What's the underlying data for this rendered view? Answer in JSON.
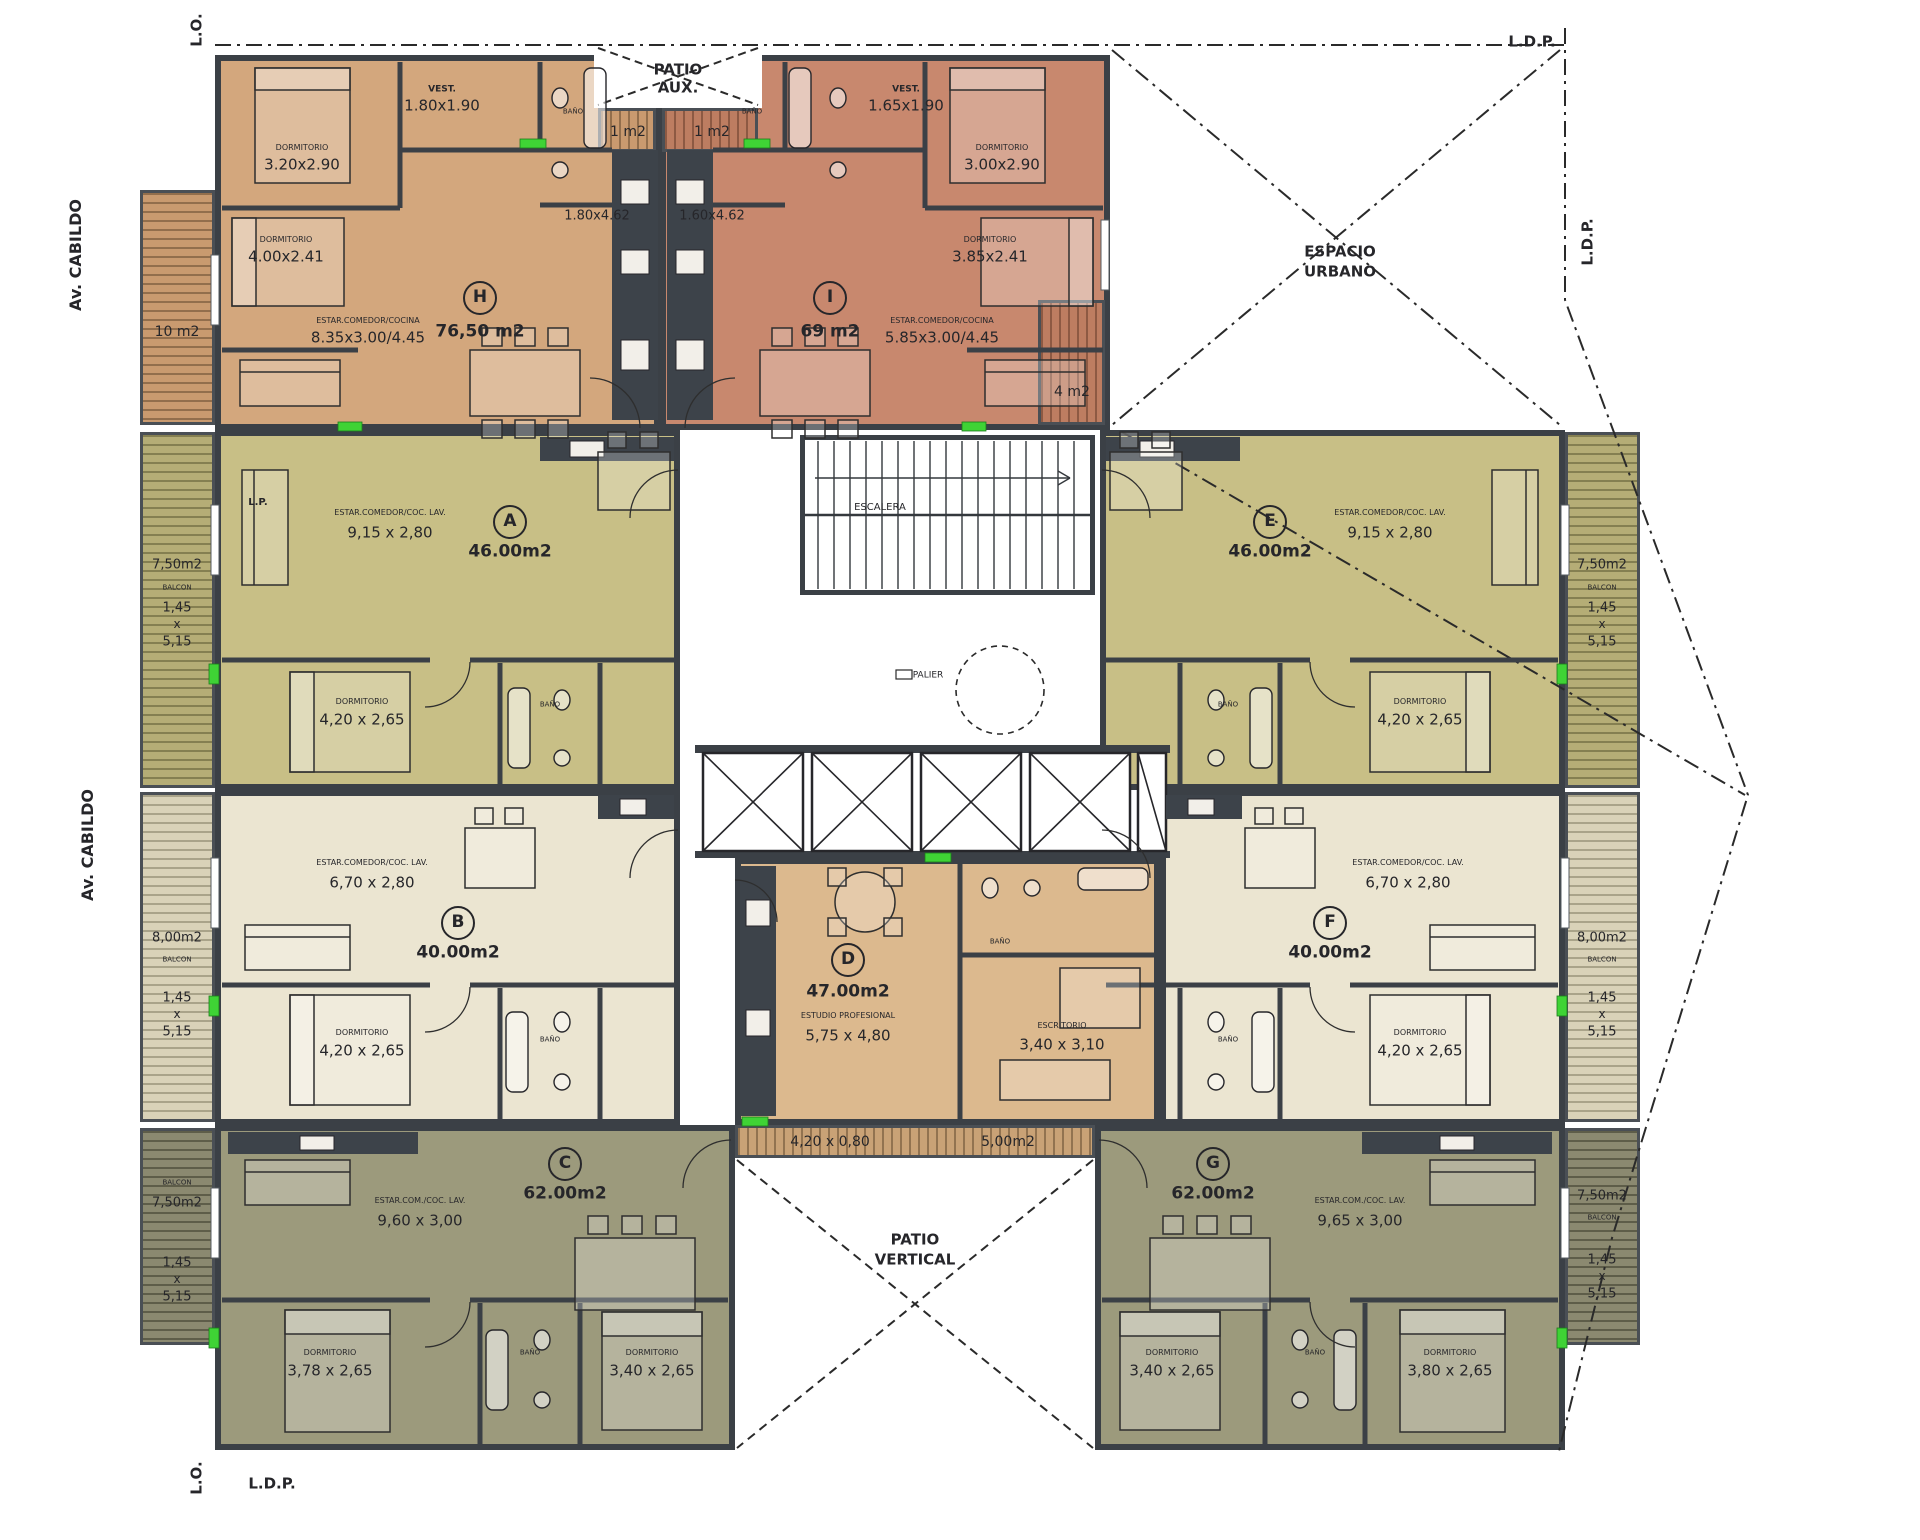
{
  "plan": {
    "street": "Av. CABILDO",
    "boundary_marks": [
      "L.O.",
      "L.D.P."
    ],
    "zones": [
      "PATIO AUX.",
      "ESPACIO URBANO",
      "PATIO VERTICAL",
      "ESCALERA",
      "PALIER"
    ]
  },
  "colors": {
    "unit_h": "#d3a77d",
    "unit_i": "#c8886e",
    "unit_a_e": "#c8bf86",
    "unit_b_f": "#ebe5d1",
    "unit_c_g": "#9c9a7c",
    "unit_d": "#dcb98e",
    "walls": "#3b4046",
    "accent_green": "#3fd335"
  },
  "units": [
    {
      "letter": "H",
      "area": "76,50 m2",
      "rooms": [
        {
          "name": "VEST.",
          "dims": "1.80x1.90"
        },
        {
          "name": "DORMITORIO",
          "dims": "3.20x2.90"
        },
        {
          "name": "DORMITORIO",
          "dims": "4.00x2.41"
        },
        {
          "name": "ESTAR.COMEDOR/COCINA",
          "dims": "8.35x3.00/4.45"
        },
        {
          "name": "COCINA",
          "dims": "1.80x4.62"
        }
      ],
      "balconies": [
        "10 m2",
        "1 m2"
      ]
    },
    {
      "letter": "I",
      "area": "69 m2",
      "rooms": [
        {
          "name": "VEST.",
          "dims": "1.65x1.90"
        },
        {
          "name": "DORMITORIO",
          "dims": "3.00x2.90"
        },
        {
          "name": "DORMITORIO",
          "dims": "3.85x2.41"
        },
        {
          "name": "ESTAR.COMEDOR/COCINA",
          "dims": "5.85x3.00/4.45"
        },
        {
          "name": "COCINA",
          "dims": "1.60x4.62"
        }
      ],
      "balconies": [
        "4 m2",
        "1 m2"
      ]
    },
    {
      "letter": "A",
      "area": "46.00m2",
      "rooms": [
        {
          "name": "ESTAR.COMEDOR/COC. LAV.",
          "dims": "9,15 x 2,80"
        },
        {
          "name": "DORMITORIO",
          "dims": "4,20 x 2,65"
        }
      ],
      "balconies": [
        "7,50m2 (1,45 x 5,15)"
      ]
    },
    {
      "letter": "B",
      "area": "40.00m2",
      "rooms": [
        {
          "name": "ESTAR.COMEDOR/COC. LAV.",
          "dims": "6,70 x 2,80"
        },
        {
          "name": "DORMITORIO",
          "dims": "4,20 x 2,65"
        }
      ],
      "balconies": [
        "8,00m2 (1,45 x 5,15)"
      ]
    },
    {
      "letter": "C",
      "area": "62.00m2",
      "rooms": [
        {
          "name": "ESTAR.COM./COC. LAV.",
          "dims": "9,60 x 3,00"
        },
        {
          "name": "DORMITORIO",
          "dims": "3,78 x 2,65"
        },
        {
          "name": "DORMITORIO",
          "dims": "3,40 x 2,65"
        }
      ],
      "balconies": [
        "7,50m2 (1,45 x 5,15)"
      ]
    },
    {
      "letter": "D",
      "area": "47.00m2",
      "rooms": [
        {
          "name": "ESTUDIO PROFESIONAL",
          "dims": "5,75 x 4,80"
        },
        {
          "name": "ESCRITORIO",
          "dims": "3,40 x 3,10"
        }
      ],
      "balconies": [
        "5,00m2 (4,20 x 0,80)"
      ]
    },
    {
      "letter": "E",
      "area": "46.00m2",
      "rooms": [
        {
          "name": "ESTAR.COMEDOR/COC. LAV.",
          "dims": "9,15 x 2,80"
        },
        {
          "name": "DORMITORIO",
          "dims": "4,20 x 2,65"
        }
      ],
      "balconies": [
        "7,50m2 (1,45 x 5,15)"
      ]
    },
    {
      "letter": "F",
      "area": "40.00m2",
      "rooms": [
        {
          "name": "ESTAR.COMEDOR/COC. LAV.",
          "dims": "6,70 x 2,80"
        },
        {
          "name": "DORMITORIO",
          "dims": "4,20 x 2,65"
        }
      ],
      "balconies": [
        "8,00m2 (1,45 x 5,15)"
      ]
    },
    {
      "letter": "G",
      "area": "62.00m2",
      "rooms": [
        {
          "name": "ESTAR.COM./COC. LAV.",
          "dims": "9,65 x 3,00"
        },
        {
          "name": "DORMITORIO",
          "dims": "3,40 x 2,65"
        },
        {
          "name": "DORMITORIO",
          "dims": "3,80 x 2,65"
        }
      ],
      "balconies": [
        "7,50m2 (1,45 x 5,15)"
      ]
    }
  ],
  "unit_badges": [
    {
      "letter": "H",
      "x": 480,
      "y": 298
    },
    {
      "letter": "I",
      "x": 830,
      "y": 298
    },
    {
      "letter": "A",
      "x": 510,
      "y": 522
    },
    {
      "letter": "E",
      "x": 1270,
      "y": 522
    },
    {
      "letter": "B",
      "x": 458,
      "y": 923
    },
    {
      "letter": "F",
      "x": 1330,
      "y": 923
    },
    {
      "letter": "C",
      "x": 565,
      "y": 1164
    },
    {
      "letter": "G",
      "x": 1213,
      "y": 1164
    },
    {
      "letter": "D",
      "x": 848,
      "y": 960
    }
  ],
  "labels": [
    {
      "t": "L.O.",
      "x": 197,
      "y": 30,
      "fs": 15,
      "b": 1,
      "rot": 1
    },
    {
      "t": "Av. CABILDO",
      "x": 76,
      "y": 255,
      "fs": 16,
      "b": 1,
      "rot": 1
    },
    {
      "t": "Av. CABILDO",
      "x": 88,
      "y": 845,
      "fs": 16,
      "b": 1,
      "rot": 1
    },
    {
      "t": "L.D.P.",
      "x": 1532,
      "y": 42,
      "fs": 15,
      "b": 1
    },
    {
      "t": "L.D.P.",
      "x": 1588,
      "y": 242,
      "fs": 15,
      "b": 1,
      "rot": 1
    },
    {
      "t": "L.O.",
      "x": 197,
      "y": 1478,
      "fs": 15,
      "b": 1,
      "rot": 1
    },
    {
      "t": "L.D.P.",
      "x": 272,
      "y": 1484,
      "fs": 15,
      "b": 1
    },
    {
      "t": "L.P.",
      "x": 258,
      "y": 503,
      "fs": 10,
      "b": 1
    },
    {
      "t": "PATIO",
      "x": 678,
      "y": 70,
      "fs": 15,
      "b": 1
    },
    {
      "t": "AUX.",
      "x": 678,
      "y": 88,
      "fs": 15,
      "b": 1
    },
    {
      "t": "ESPACIO",
      "x": 1340,
      "y": 252,
      "fs": 15,
      "b": 1
    },
    {
      "t": "URBANO",
      "x": 1340,
      "y": 272,
      "fs": 15,
      "b": 1
    },
    {
      "t": "PATIO",
      "x": 915,
      "y": 1240,
      "fs": 15,
      "b": 1
    },
    {
      "t": "VERTICAL",
      "x": 915,
      "y": 1260,
      "fs": 15,
      "b": 1
    },
    {
      "t": "ESCALERA",
      "x": 880,
      "y": 508,
      "fs": 10
    },
    {
      "t": "PALIER",
      "x": 928,
      "y": 676,
      "fs": 9
    },
    {
      "t": "1 m2",
      "x": 628,
      "y": 132,
      "fs": 14
    },
    {
      "t": "1 m2",
      "x": 712,
      "y": 132,
      "fs": 14
    },
    {
      "t": "10 m2",
      "x": 177,
      "y": 332,
      "fs": 14
    },
    {
      "t": "4 m2",
      "x": 1072,
      "y": 392,
      "fs": 14
    },
    {
      "t": "VEST.",
      "x": 442,
      "y": 90,
      "fs": 9,
      "b": 1
    },
    {
      "t": "1.80x1.90",
      "x": 442,
      "y": 106,
      "fs": 15
    },
    {
      "t": "DORMITORIO",
      "x": 302,
      "y": 148,
      "fs": 8
    },
    {
      "t": "3.20x2.90",
      "x": 302,
      "y": 165,
      "fs": 15
    },
    {
      "t": "DORMITORIO",
      "x": 286,
      "y": 240,
      "fs": 8
    },
    {
      "t": "4.00x2.41",
      "x": 286,
      "y": 257,
      "fs": 15
    },
    {
      "t": "76,50 m2",
      "x": 480,
      "y": 332,
      "fs": 17,
      "b": 1
    },
    {
      "t": "ESTAR.COMEDOR/COCINA",
      "x": 368,
      "y": 321,
      "fs": 8
    },
    {
      "t": "8.35x3.00/4.45",
      "x": 368,
      "y": 338,
      "fs": 15
    },
    {
      "t": "1.80x4.62",
      "x": 597,
      "y": 216,
      "fs": 13
    },
    {
      "t": "BAÑO",
      "x": 573,
      "y": 112,
      "fs": 7
    },
    {
      "t": "VEST.",
      "x": 906,
      "y": 90,
      "fs": 9,
      "b": 1
    },
    {
      "t": "1.65x1.90",
      "x": 906,
      "y": 106,
      "fs": 15
    },
    {
      "t": "DORMITORIO",
      "x": 1002,
      "y": 148,
      "fs": 8
    },
    {
      "t": "3.00x2.90",
      "x": 1002,
      "y": 165,
      "fs": 15
    },
    {
      "t": "DORMITORIO",
      "x": 990,
      "y": 240,
      "fs": 8
    },
    {
      "t": "3.85x2.41",
      "x": 990,
      "y": 257,
      "fs": 15
    },
    {
      "t": "69 m2",
      "x": 830,
      "y": 332,
      "fs": 17,
      "b": 1
    },
    {
      "t": "ESTAR.COMEDOR/COCINA",
      "x": 942,
      "y": 321,
      "fs": 8
    },
    {
      "t": "5.85x3.00/4.45",
      "x": 942,
      "y": 338,
      "fs": 15
    },
    {
      "t": "1.60x4.62",
      "x": 712,
      "y": 216,
      "fs": 13
    },
    {
      "t": "BAÑO",
      "x": 752,
      "y": 112,
      "fs": 7
    },
    {
      "t": "ESTAR.COMEDOR/COC. LAV.",
      "x": 390,
      "y": 513,
      "fs": 8
    },
    {
      "t": "9,15 x 2,80",
      "x": 390,
      "y": 533,
      "fs": 15
    },
    {
      "t": "46.00m2",
      "x": 510,
      "y": 552,
      "fs": 17,
      "b": 1
    },
    {
      "t": "DORMITORIO",
      "x": 362,
      "y": 702,
      "fs": 8
    },
    {
      "t": "4,20 x 2,65",
      "x": 362,
      "y": 720,
      "fs": 15
    },
    {
      "t": "BAÑO",
      "x": 550,
      "y": 705,
      "fs": 7
    },
    {
      "t": "7,50m2",
      "x": 177,
      "y": 565,
      "fs": 13
    },
    {
      "t": "BALCON",
      "x": 177,
      "y": 588,
      "fs": 7
    },
    {
      "t": "1,45",
      "x": 177,
      "y": 608,
      "fs": 13
    },
    {
      "t": "x",
      "x": 177,
      "y": 624,
      "fs": 12
    },
    {
      "t": "5,15",
      "x": 177,
      "y": 642,
      "fs": 13
    },
    {
      "t": "ESTAR.COMEDOR/COC. LAV.",
      "x": 1390,
      "y": 513,
      "fs": 8
    },
    {
      "t": "9,15 x 2,80",
      "x": 1390,
      "y": 533,
      "fs": 15
    },
    {
      "t": "46.00m2",
      "x": 1270,
      "y": 552,
      "fs": 17,
      "b": 1
    },
    {
      "t": "DORMITORIO",
      "x": 1420,
      "y": 702,
      "fs": 8
    },
    {
      "t": "4,20 x 2,65",
      "x": 1420,
      "y": 720,
      "fs": 15
    },
    {
      "t": "BAÑO",
      "x": 1228,
      "y": 705,
      "fs": 7
    },
    {
      "t": "7,50m2",
      "x": 1602,
      "y": 565,
      "fs": 13
    },
    {
      "t": "BALCON",
      "x": 1602,
      "y": 588,
      "fs": 7
    },
    {
      "t": "1,45",
      "x": 1602,
      "y": 608,
      "fs": 13
    },
    {
      "t": "x",
      "x": 1602,
      "y": 624,
      "fs": 12
    },
    {
      "t": "5,15",
      "x": 1602,
      "y": 642,
      "fs": 13
    },
    {
      "t": "ESTAR.COMEDOR/COC. LAV.",
      "x": 372,
      "y": 863,
      "fs": 8
    },
    {
      "t": "6,70 x 2,80",
      "x": 372,
      "y": 883,
      "fs": 15
    },
    {
      "t": "40.00m2",
      "x": 458,
      "y": 953,
      "fs": 17,
      "b": 1
    },
    {
      "t": "DORMITORIO",
      "x": 362,
      "y": 1033,
      "fs": 8
    },
    {
      "t": "4,20 x 2,65",
      "x": 362,
      "y": 1051,
      "fs": 15
    },
    {
      "t": "BAÑO",
      "x": 550,
      "y": 1040,
      "fs": 7
    },
    {
      "t": "8,00m2",
      "x": 177,
      "y": 938,
      "fs": 13
    },
    {
      "t": "BALCON",
      "x": 177,
      "y": 960,
      "fs": 7
    },
    {
      "t": "1,45",
      "x": 177,
      "y": 998,
      "fs": 13
    },
    {
      "t": "x",
      "x": 177,
      "y": 1014,
      "fs": 12
    },
    {
      "t": "5,15",
      "x": 177,
      "y": 1032,
      "fs": 13
    },
    {
      "t": "ESTAR.COMEDOR/COC. LAV.",
      "x": 1408,
      "y": 863,
      "fs": 8
    },
    {
      "t": "6,70 x 2,80",
      "x": 1408,
      "y": 883,
      "fs": 15
    },
    {
      "t": "40.00m2",
      "x": 1330,
      "y": 953,
      "fs": 17,
      "b": 1
    },
    {
      "t": "DORMITORIO",
      "x": 1420,
      "y": 1033,
      "fs": 8
    },
    {
      "t": "4,20 x 2,65",
      "x": 1420,
      "y": 1051,
      "fs": 15
    },
    {
      "t": "BAÑO",
      "x": 1228,
      "y": 1040,
      "fs": 7
    },
    {
      "t": "8,00m2",
      "x": 1602,
      "y": 938,
      "fs": 13
    },
    {
      "t": "BALCON",
      "x": 1602,
      "y": 960,
      "fs": 7
    },
    {
      "t": "1,45",
      "x": 1602,
      "y": 998,
      "fs": 13
    },
    {
      "t": "x",
      "x": 1602,
      "y": 1014,
      "fs": 12
    },
    {
      "t": "5,15",
      "x": 1602,
      "y": 1032,
      "fs": 13
    },
    {
      "t": "62.00m2",
      "x": 565,
      "y": 1194,
      "fs": 17,
      "b": 1
    },
    {
      "t": "ESTAR.COM./COC. LAV.",
      "x": 420,
      "y": 1201,
      "fs": 8
    },
    {
      "t": "9,60 x 3,00",
      "x": 420,
      "y": 1221,
      "fs": 15
    },
    {
      "t": "DORMITORIO",
      "x": 330,
      "y": 1353,
      "fs": 8
    },
    {
      "t": "3,78 x 2,65",
      "x": 330,
      "y": 1371,
      "fs": 15
    },
    {
      "t": "DORMITORIO",
      "x": 652,
      "y": 1353,
      "fs": 8
    },
    {
      "t": "3,40 x 2,65",
      "x": 652,
      "y": 1371,
      "fs": 15
    },
    {
      "t": "BAÑO",
      "x": 530,
      "y": 1353,
      "fs": 7
    },
    {
      "t": "BALCON",
      "x": 177,
      "y": 1183,
      "fs": 7
    },
    {
      "t": "7,50m2",
      "x": 177,
      "y": 1203,
      "fs": 13
    },
    {
      "t": "1,45",
      "x": 177,
      "y": 1263,
      "fs": 13
    },
    {
      "t": "x",
      "x": 177,
      "y": 1279,
      "fs": 12
    },
    {
      "t": "5,15",
      "x": 177,
      "y": 1297,
      "fs": 13
    },
    {
      "t": "62.00m2",
      "x": 1213,
      "y": 1194,
      "fs": 17,
      "b": 1
    },
    {
      "t": "ESTAR.COM./COC. LAV.",
      "x": 1360,
      "y": 1201,
      "fs": 8
    },
    {
      "t": "9,65 x 3,00",
      "x": 1360,
      "y": 1221,
      "fs": 15
    },
    {
      "t": "DORMITORIO",
      "x": 1172,
      "y": 1353,
      "fs": 8
    },
    {
      "t": "3,40 x 2,65",
      "x": 1172,
      "y": 1371,
      "fs": 15
    },
    {
      "t": "DORMITORIO",
      "x": 1450,
      "y": 1353,
      "fs": 8
    },
    {
      "t": "3,80 x 2,65",
      "x": 1450,
      "y": 1371,
      "fs": 15
    },
    {
      "t": "BAÑO",
      "x": 1315,
      "y": 1353,
      "fs": 7
    },
    {
      "t": "7,50m2",
      "x": 1602,
      "y": 1196,
      "fs": 13
    },
    {
      "t": "BALCON",
      "x": 1602,
      "y": 1218,
      "fs": 7
    },
    {
      "t": "1,45",
      "x": 1602,
      "y": 1260,
      "fs": 13
    },
    {
      "t": "x",
      "x": 1602,
      "y": 1276,
      "fs": 12
    },
    {
      "t": "5,15",
      "x": 1602,
      "y": 1294,
      "fs": 13
    },
    {
      "t": "47.00m2",
      "x": 848,
      "y": 992,
      "fs": 17,
      "b": 1
    },
    {
      "t": "ESTUDIO PROFESIONAL",
      "x": 848,
      "y": 1016,
      "fs": 8
    },
    {
      "t": "5,75 x 4,80",
      "x": 848,
      "y": 1036,
      "fs": 15
    },
    {
      "t": "ESCRITORIO",
      "x": 1062,
      "y": 1026,
      "fs": 8
    },
    {
      "t": "3,40 x 3,10",
      "x": 1062,
      "y": 1045,
      "fs": 15
    },
    {
      "t": "BAÑO",
      "x": 1000,
      "y": 942,
      "fs": 7
    },
    {
      "t": "4,20 x 0,80",
      "x": 830,
      "y": 1142,
      "fs": 14
    },
    {
      "t": "5,00m2",
      "x": 1008,
      "y": 1142,
      "fs": 14
    }
  ]
}
